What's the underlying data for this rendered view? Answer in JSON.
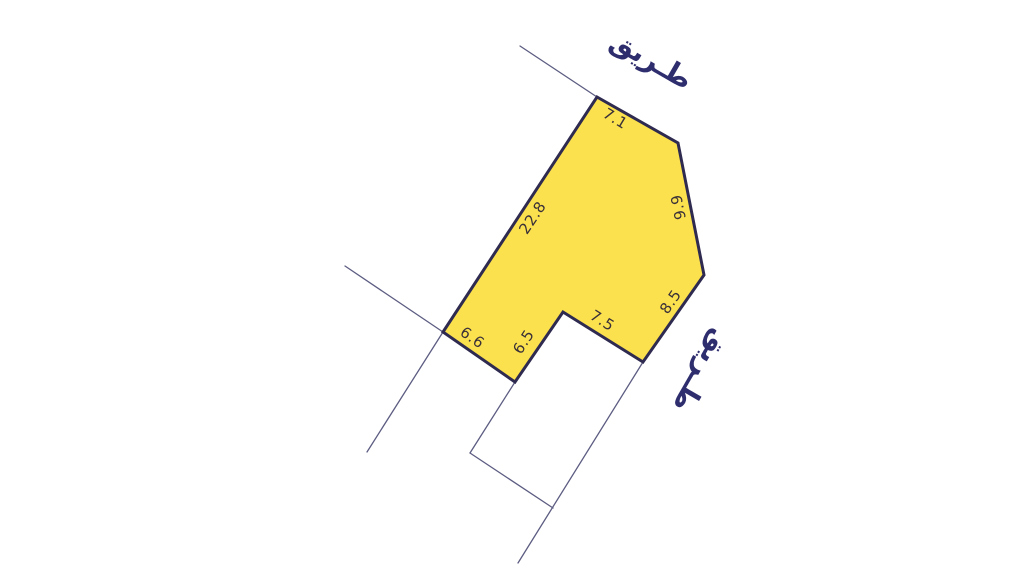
{
  "map": {
    "title": "land-parcel-survey-plan",
    "canvas": {
      "width": 1024,
      "height": 576,
      "background": "#ffffff"
    },
    "colors": {
      "parcel_fill": "#FBE14D",
      "parcel_stroke": "#2E2A50",
      "road_line": "#5C5C82",
      "dimension_text": "#3A3038",
      "road_label_text": "#2E2D6E"
    },
    "parcel": {
      "name": "parcel-polygon",
      "points": [
        [
          597,
          97
        ],
        [
          678,
          143
        ],
        [
          704,
          275
        ],
        [
          643,
          362
        ],
        [
          563,
          312
        ],
        [
          515,
          382
        ],
        [
          443,
          332
        ]
      ],
      "stroke_width": 3,
      "dimensions": [
        {
          "name": "dimension-7-1",
          "text": "7.1",
          "x": 615,
          "y": 119,
          "rotate": 31
        },
        {
          "name": "dimension-9-9",
          "text": "9.9",
          "x": 679,
          "y": 207,
          "rotate": -101
        },
        {
          "name": "dimension-22-8",
          "text": "22.8",
          "x": 533,
          "y": 218,
          "rotate": -56
        },
        {
          "name": "dimension-8-5",
          "text": "8.5",
          "x": 671,
          "y": 302,
          "rotate": -56
        },
        {
          "name": "dimension-7-5",
          "text": "7.5",
          "x": 602,
          "y": 321,
          "rotate": 32
        },
        {
          "name": "dimension-6-5",
          "text": "6.5",
          "x": 524,
          "y": 342,
          "rotate": -57
        },
        {
          "name": "dimension-6-6",
          "text": "6.6",
          "x": 472,
          "y": 338,
          "rotate": 35
        }
      ]
    },
    "boundary_lines": [
      {
        "name": "road-edge-top",
        "x1": 520,
        "y1": 46,
        "x2": 597,
        "y2": 97
      },
      {
        "name": "road-edge-west-upper",
        "x1": 345,
        "y1": 266,
        "x2": 443,
        "y2": 332
      },
      {
        "name": "road-edge-west-lower",
        "x1": 443,
        "y1": 332,
        "x2": 367,
        "y2": 452
      },
      {
        "name": "neighbor-parcel-west-edge",
        "x1": 515,
        "y1": 382,
        "x2": 470,
        "y2": 453
      },
      {
        "name": "neighbor-parcel-south-edge",
        "x1": 470,
        "y1": 453,
        "x2": 553,
        "y2": 508
      },
      {
        "name": "road-edge-east",
        "x1": 518,
        "y1": 563,
        "x2": 643,
        "y2": 362
      }
    ],
    "road_labels": [
      {
        "name": "road-label-top",
        "text": "طـريق",
        "x": 651,
        "y": 61,
        "rotate": 30
      },
      {
        "name": "road-label-east",
        "text": "طـريق",
        "x": 701,
        "y": 371,
        "rotate": 120
      }
    ]
  }
}
